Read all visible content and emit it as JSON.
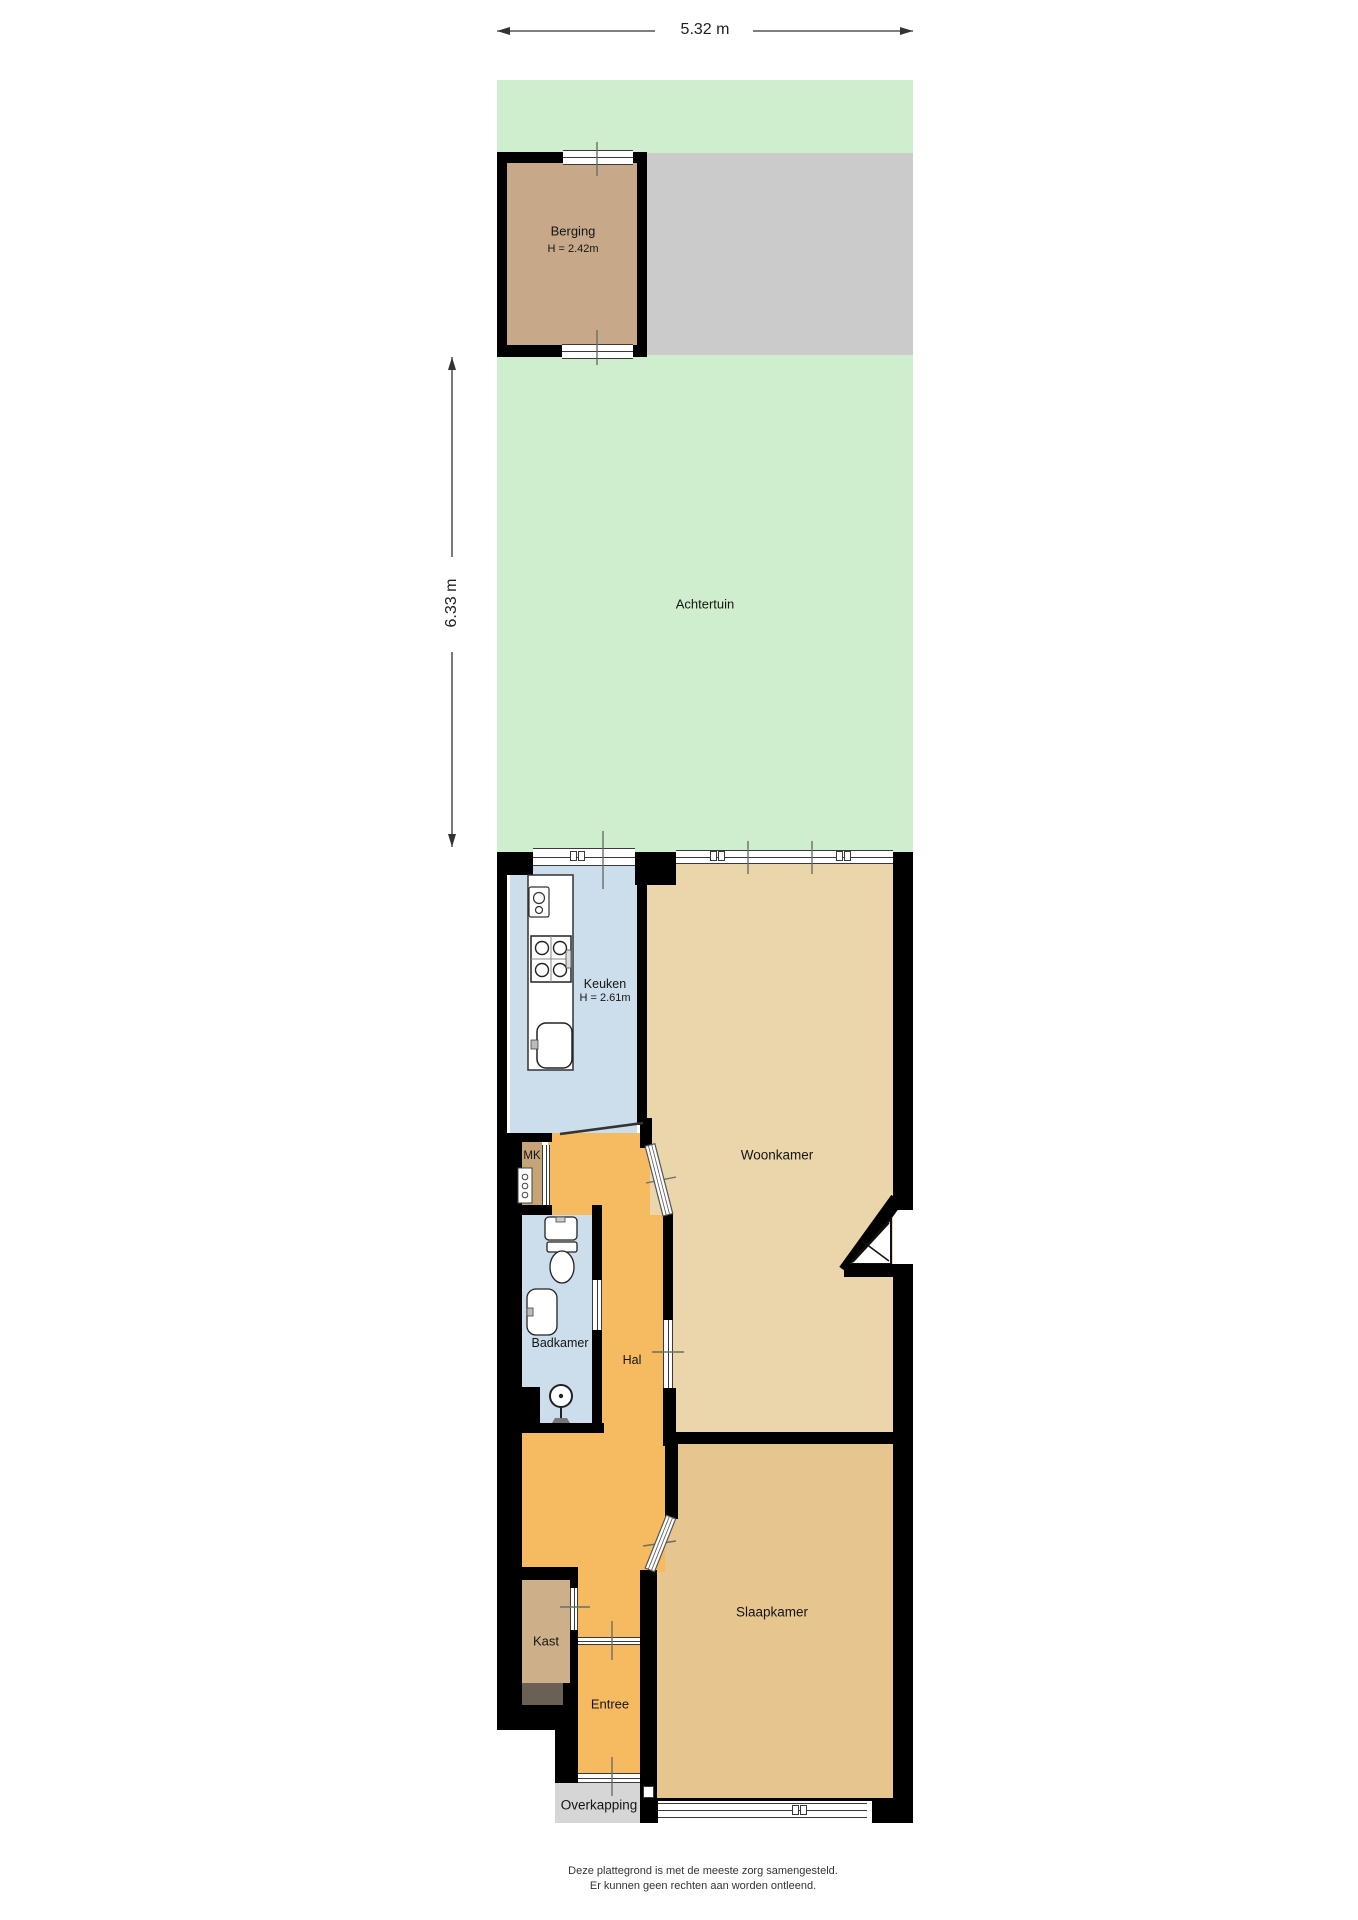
{
  "dimensions": {
    "width": "5.32 m",
    "height": "6.33 m"
  },
  "rooms": {
    "berging": {
      "name": "Berging",
      "ceiling": "H = 2.42m"
    },
    "achtertuin": {
      "name": "Achtertuin"
    },
    "keuken": {
      "name": "Keuken",
      "ceiling": "H = 2.61m"
    },
    "woonkamer": {
      "name": "Woonkamer"
    },
    "meterkast": {
      "name": "MK"
    },
    "badkamer": {
      "name": "Badkamer"
    },
    "hal": {
      "name": "Hal"
    },
    "kast": {
      "name": "Kast"
    },
    "slaapkamer": {
      "name": "Slaapkamer"
    },
    "entree": {
      "name": "Entree"
    },
    "overkapping": {
      "name": "Overkapping"
    }
  },
  "footer": {
    "line1": "Deze plattegrond is met de meeste zorg samengesteld.",
    "line2": "Er kunnen geen rechten aan worden ontleend."
  },
  "colors": {
    "wall": "#000000",
    "garden": "#cfeecd",
    "paving": "#cbcbcb",
    "berging_floor": "#c7a989",
    "kitchen_floor": "#ccddeb",
    "woonkamer_floor": "#ebd5ab",
    "hal_floor": "#f6bb61",
    "slaapkamer_floor": "#e6c68e",
    "kast_floor": "#cdb08a",
    "mk_floor": "#c5a478",
    "overkapping": "#d6d6d6",
    "dark_patch": "#6b6054",
    "tick": "#667067"
  }
}
